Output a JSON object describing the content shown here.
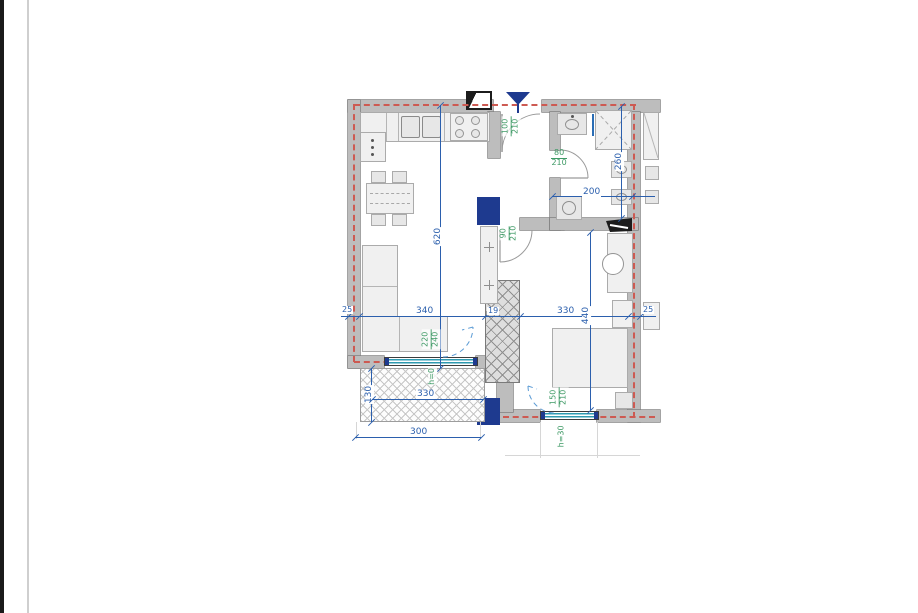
{
  "document": {
    "background": "#ffffff"
  },
  "plan": {
    "dimensions": {
      "living_height": "620",
      "wall_left": "25",
      "living_width": "340",
      "partition": "19",
      "bedroom_width": "330",
      "bedroom_depth": "440",
      "wall_right": "25",
      "bathroom_width": "200",
      "bathroom_depth": "260",
      "balcony_depth": "130",
      "balcony_width": "330",
      "balcony_outer_width": "300"
    },
    "openings": {
      "entrance_door": {
        "width": "100",
        "height": "210"
      },
      "bathroom_door": {
        "width": "80",
        "height": "210"
      },
      "hall_door": {
        "width": "90",
        "height": "210"
      },
      "balcony_door": {
        "width": "220",
        "height": "240",
        "sill": "h=0"
      },
      "bedroom_window": {
        "width": "150",
        "height": "210",
        "sill": "h=30"
      }
    },
    "colors": {
      "wall_fill": "#bdbdbd",
      "dimension_blue": "#2b5fad",
      "label_green": "#3f9a66",
      "insulation_red": "#cd5a52",
      "column_navy": "#1e3a8f",
      "glazing_teal": "#2e9ab0"
    }
  }
}
